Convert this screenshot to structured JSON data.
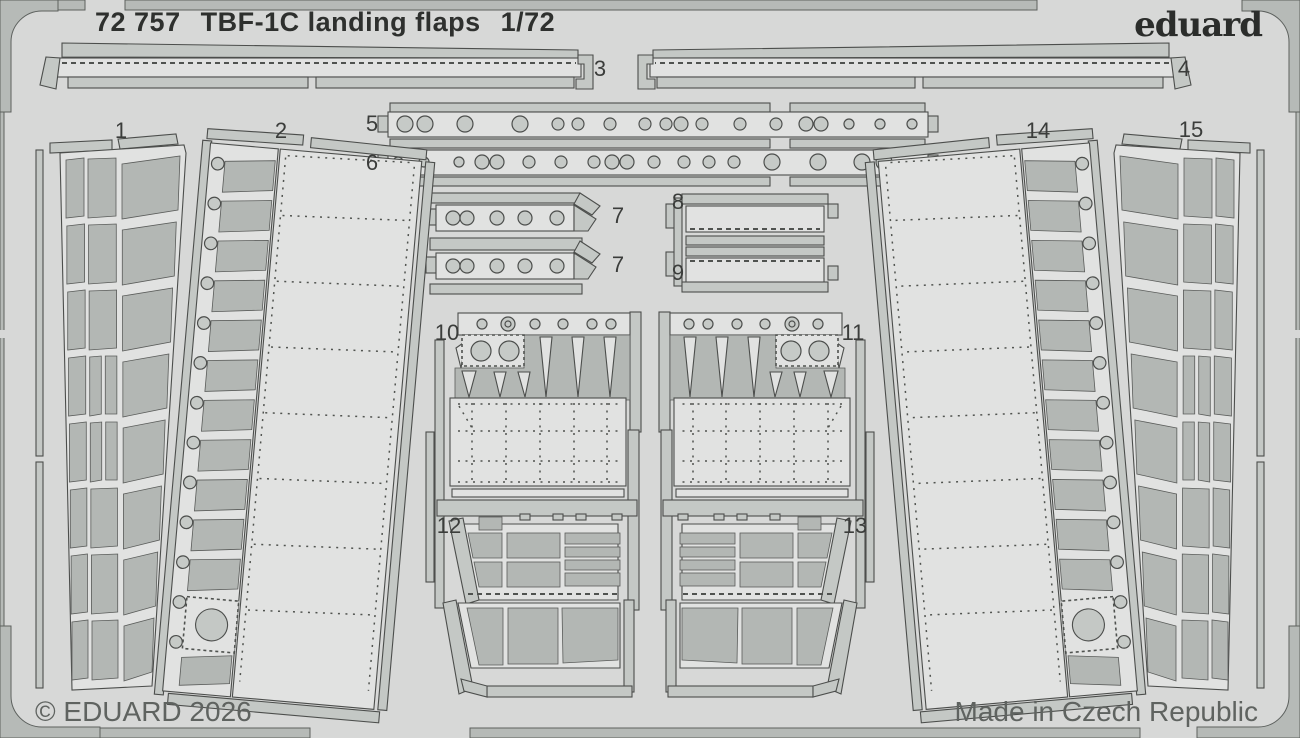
{
  "header": {
    "catalog_number": "72 757",
    "title": "TBF-1C  landing flaps",
    "scale": "1/72",
    "brand_logo": "eduard"
  },
  "footer": {
    "copyright": "© EDUARD 2026",
    "origin": "Made in Czech Republic"
  },
  "parts": {
    "p1": {
      "label": "1"
    },
    "p2": {
      "label": "2"
    },
    "p3": {
      "label": "3"
    },
    "p4": {
      "label": "4"
    },
    "p5": {
      "label": "5"
    },
    "p6": {
      "label": "6"
    },
    "p7a": {
      "label": "7"
    },
    "p7b": {
      "label": "7"
    },
    "p8": {
      "label": "8"
    },
    "p9": {
      "label": "9"
    },
    "p10": {
      "label": "10"
    },
    "p11": {
      "label": "11"
    },
    "p12": {
      "label": "12"
    },
    "p13": {
      "label": "13"
    },
    "p14": {
      "label": "14"
    },
    "p15": {
      "label": "15"
    }
  },
  "colors": {
    "sheet_background": "#d7d8d7",
    "fret_frame": "#b6bab7",
    "part_metal": "#c4c8c5",
    "panel_light": "#e1e2e1",
    "panel_dark": "#b3b7b4",
    "outline": "#4c4e4c",
    "title_text": "#2e302e",
    "footer_text": "#5f6360"
  }
}
